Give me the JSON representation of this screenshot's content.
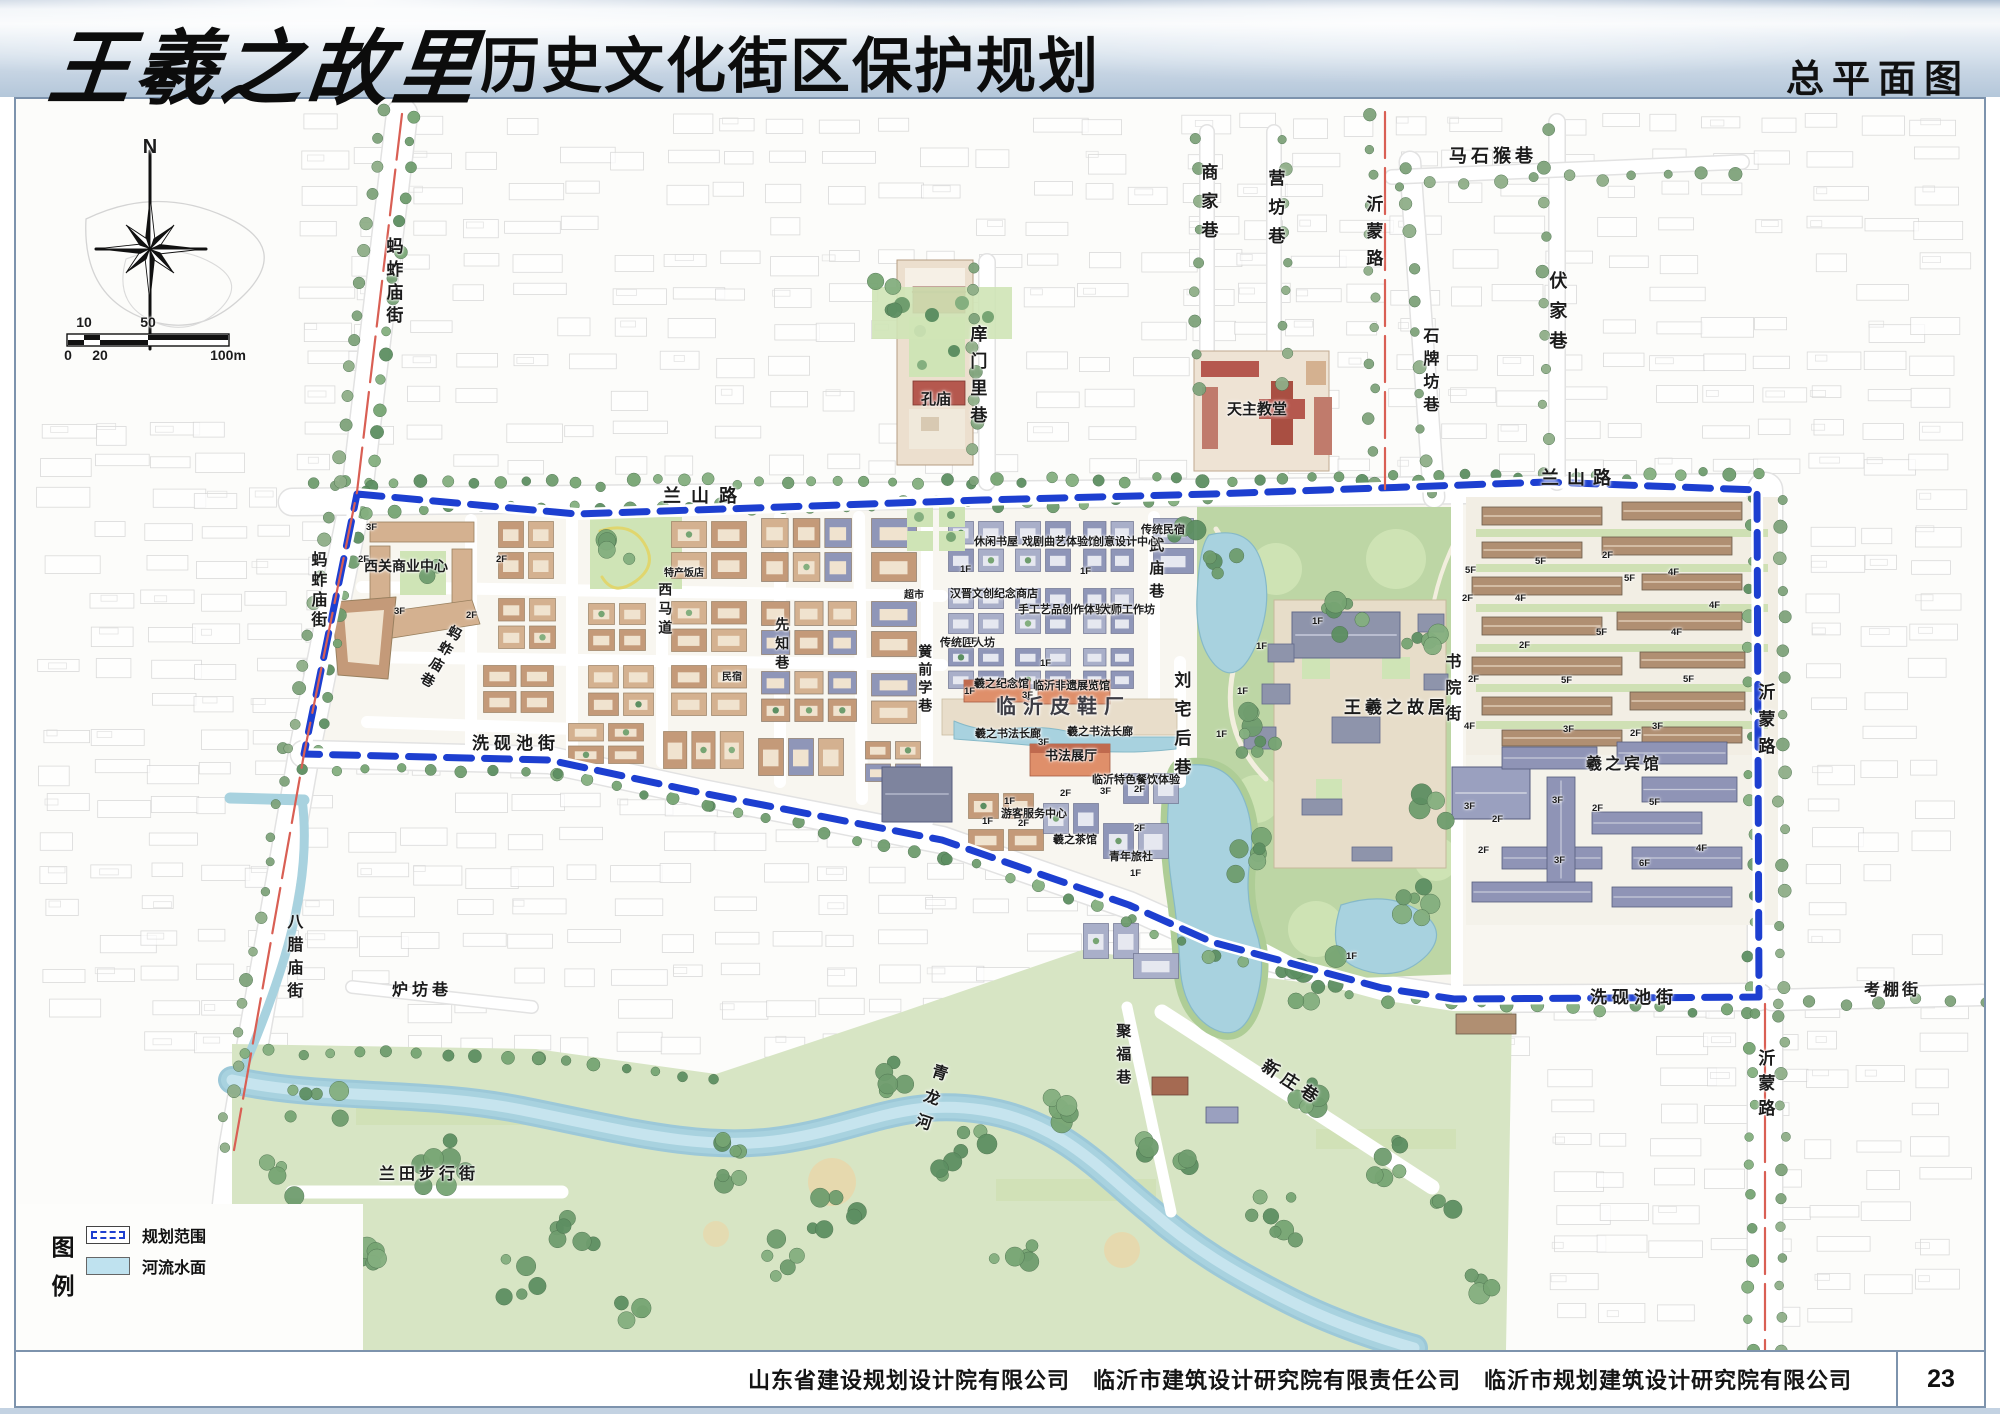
{
  "header": {
    "title_calligraphy": "王羲之故里",
    "title_rest": "历史文化街区保护规划",
    "corner_title": "总平面图"
  },
  "compass": {
    "label": "N"
  },
  "scalebar": {
    "top": [
      [
        "10",
        0.1
      ],
      [
        "50",
        0.5
      ]
    ],
    "bottom": [
      [
        "0",
        0
      ],
      [
        "20",
        0.2
      ],
      [
        "100m",
        1
      ]
    ]
  },
  "legend": {
    "title": "图例",
    "items": [
      {
        "label": "规划范围",
        "type": "boundary"
      },
      {
        "label": "河流水面",
        "type": "water"
      }
    ]
  },
  "footer": {
    "companies": "山东省建设规划设计院有限公司　临沂市建筑设计研究院有限责任公司　临沂市规划建筑设计研究院有限公司",
    "page": "23"
  },
  "colors": {
    "boundary": "#1d3fd0",
    "road_red": "#d95f54",
    "water": "#a8d2df",
    "water_edge": "#86b9c8",
    "park": "#bdd6a5",
    "lawn": "#cfe4b6",
    "band": "#d7e5c4",
    "tan_roof": "#c49a79",
    "tan_roof2": "#d4b190",
    "tan_body": "#f0e3cf",
    "blue_roof": "#8f96b8",
    "blue_roof2": "#a9afc9",
    "blue_body": "#e6e8f0",
    "red_roof": "#b5584e",
    "orange_roof": "#df8f6a",
    "plaza": "#e8ddca",
    "fabric": "#cfcfcf",
    "tree": [
      "#6f9d6e",
      "#84af7f",
      "#5d8f62",
      "#77a573"
    ],
    "tree_out": [
      "#7fa37b",
      "#8fae88"
    ]
  },
  "map_labels": [
    {
      "t": "N",
      "x": 134,
      "y": 38,
      "o": "h",
      "s": 20,
      "w": 800,
      "ctr": 1,
      "n": "north-label"
    },
    {
      "t": "蚂蚱庙街",
      "x": 368,
      "y": 138,
      "o": "v",
      "s": 17,
      "w": 700,
      "ls": 6,
      "n": "street-label"
    },
    {
      "t": "马石猴巷",
      "x": 1433,
      "y": 48,
      "o": "h",
      "s": 18,
      "w": 700,
      "ls": 4,
      "n": "street-label"
    },
    {
      "t": "商家巷",
      "x": 1183,
      "y": 64,
      "o": "v",
      "s": 17,
      "w": 700,
      "ls": 12,
      "n": "street-label"
    },
    {
      "t": "营坊巷",
      "x": 1250,
      "y": 70,
      "o": "v",
      "s": 17,
      "w": 700,
      "ls": 12,
      "n": "street-label"
    },
    {
      "t": "沂蒙路",
      "x": 1348,
      "y": 96,
      "o": "v",
      "s": 17,
      "w": 700,
      "ls": 10,
      "n": "street-label"
    },
    {
      "t": "伏家巷",
      "x": 1532,
      "y": 172,
      "o": "v",
      "s": 18,
      "w": 700,
      "ls": 12,
      "n": "street-label"
    },
    {
      "t": "石牌坊巷",
      "x": 1404,
      "y": 228,
      "o": "v",
      "s": 16,
      "w": 700,
      "ls": 7,
      "n": "street-label"
    },
    {
      "t": "庠门里巷",
      "x": 952,
      "y": 226,
      "o": "v",
      "s": 17,
      "w": 700,
      "ls": 10,
      "n": "street-label"
    },
    {
      "t": "孔庙",
      "x": 905,
      "y": 293,
      "o": "h",
      "s": 15,
      "w": 700,
      "n": "poi-label"
    },
    {
      "t": "天主教堂",
      "x": 1211,
      "y": 303,
      "o": "h",
      "s": 15,
      "w": 700,
      "n": "poi-label"
    },
    {
      "t": "兰山路",
      "x": 647,
      "y": 388,
      "o": "h",
      "s": 18,
      "w": 700,
      "ls": 10,
      "n": "street-label"
    },
    {
      "t": "兰山路",
      "x": 1525,
      "y": 370,
      "o": "h",
      "s": 18,
      "w": 700,
      "ls": 8,
      "n": "street-label"
    },
    {
      "t": "西关商业中心",
      "x": 348,
      "y": 460,
      "o": "h",
      "s": 14,
      "w": 700,
      "n": "poi-label"
    },
    {
      "t": "蚂蚱庙街",
      "x": 292,
      "y": 452,
      "o": "v",
      "s": 16,
      "w": 700,
      "ls": 4,
      "n": "street-label"
    },
    {
      "t": "蚂蚱庙巷",
      "x": 436,
      "y": 524,
      "o": "v",
      "s": 14,
      "w": 700,
      "r": 30,
      "ls": 4,
      "n": "street-label"
    },
    {
      "t": "洗砚池街",
      "x": 456,
      "y": 636,
      "o": "h",
      "s": 17,
      "w": 700,
      "ls": 5,
      "n": "street-label"
    },
    {
      "t": "西马道",
      "x": 642,
      "y": 483,
      "o": "v",
      "s": 14,
      "w": 700,
      "ls": 5,
      "n": "street-label"
    },
    {
      "t": "先知巷",
      "x": 759,
      "y": 518,
      "o": "v",
      "s": 14,
      "w": 700,
      "ls": 5,
      "n": "street-label"
    },
    {
      "t": "黉前学巷",
      "x": 902,
      "y": 545,
      "o": "v",
      "s": 14,
      "w": 700,
      "ls": 4,
      "n": "street-label"
    },
    {
      "t": "武庙巷",
      "x": 1132,
      "y": 438,
      "o": "v",
      "s": 15,
      "w": 700,
      "ls": 8,
      "n": "street-label"
    },
    {
      "t": "刘宅后巷",
      "x": 1156,
      "y": 572,
      "o": "v",
      "s": 17,
      "w": 700,
      "ls": 12,
      "n": "street-label"
    },
    {
      "t": "书院街",
      "x": 1426,
      "y": 554,
      "o": "v",
      "s": 16,
      "w": 700,
      "ls": 10,
      "n": "street-label"
    },
    {
      "t": "王羲之故居",
      "x": 1328,
      "y": 600,
      "o": "h",
      "s": 17,
      "w": 800,
      "ls": 4,
      "n": "poi-label"
    },
    {
      "t": "羲之宾馆",
      "x": 1570,
      "y": 658,
      "o": "h",
      "s": 16,
      "w": 800,
      "ls": 3,
      "n": "poi-label"
    },
    {
      "t": "沂蒙路",
      "x": 1740,
      "y": 584,
      "o": "v",
      "s": 17,
      "w": 700,
      "ls": 10,
      "n": "street-label"
    },
    {
      "t": "洗砚池街",
      "x": 1574,
      "y": 890,
      "o": "h",
      "s": 17,
      "w": 700,
      "ls": 5,
      "n": "street-label"
    },
    {
      "t": "考棚街",
      "x": 1848,
      "y": 884,
      "o": "h",
      "s": 16,
      "w": 700,
      "ls": 3,
      "n": "street-label"
    },
    {
      "t": "沂蒙路",
      "x": 1740,
      "y": 950,
      "o": "v",
      "s": 17,
      "w": 700,
      "ls": 8,
      "n": "street-label"
    },
    {
      "t": "八腊庙街",
      "x": 268,
      "y": 814,
      "o": "v",
      "s": 16,
      "w": 700,
      "ls": 7,
      "n": "street-label"
    },
    {
      "t": "炉坊巷",
      "x": 376,
      "y": 884,
      "o": "h",
      "s": 16,
      "w": 700,
      "ls": 4,
      "n": "street-label"
    },
    {
      "t": "兰田步行街",
      "x": 363,
      "y": 1068,
      "o": "h",
      "s": 16,
      "w": 700,
      "ls": 4,
      "n": "street-label"
    },
    {
      "t": "青龙河",
      "x": 916,
      "y": 962,
      "o": "v",
      "s": 16,
      "w": 700,
      "r": 18,
      "ls": 10,
      "n": "street-label"
    },
    {
      "t": "聚福巷",
      "x": 1099,
      "y": 924,
      "o": "v",
      "s": 15,
      "w": 700,
      "ls": 8,
      "n": "street-label"
    },
    {
      "t": "新庄巷",
      "x": 1252,
      "y": 958,
      "o": "h",
      "s": 17,
      "w": 700,
      "r": 33,
      "ls": 6,
      "n": "street-label"
    },
    {
      "t": "特产饭店",
      "x": 648,
      "y": 470,
      "o": "h",
      "s": 10,
      "w": 600,
      "n": "facility-label"
    },
    {
      "t": "民宿",
      "x": 706,
      "y": 574,
      "o": "h",
      "s": 10,
      "w": 600,
      "n": "facility-label"
    },
    {
      "t": "超市",
      "x": 888,
      "y": 492,
      "o": "h",
      "s": 10,
      "w": 600,
      "n": "facility-label"
    },
    {
      "t": "休闲书屋",
      "x": 958,
      "y": 438,
      "o": "h",
      "s": 11,
      "w": 600,
      "n": "facility-label"
    },
    {
      "t": "戏剧曲艺体验馆",
      "x": 1006,
      "y": 438,
      "o": "h",
      "s": 11,
      "w": 600,
      "n": "facility-label"
    },
    {
      "t": "创意设计中心",
      "x": 1077,
      "y": 438,
      "o": "h",
      "s": 11,
      "w": 600,
      "n": "facility-label"
    },
    {
      "t": "传统民宿",
      "x": 1125,
      "y": 426,
      "o": "h",
      "s": 11,
      "w": 600,
      "n": "facility-label"
    },
    {
      "t": "汉晋文创纪念商店",
      "x": 934,
      "y": 490,
      "o": "h",
      "s": 11,
      "w": 600,
      "n": "facility-label"
    },
    {
      "t": "手工艺品创作体验馆",
      "x": 1002,
      "y": 506,
      "o": "h",
      "s": 11,
      "w": 600,
      "n": "facility-label"
    },
    {
      "t": "大师工作坊",
      "x": 1084,
      "y": 506,
      "o": "h",
      "s": 11,
      "w": 600,
      "n": "facility-label"
    },
    {
      "t": "传统匠人坊",
      "x": 924,
      "y": 539,
      "o": "h",
      "s": 11,
      "w": 600,
      "n": "facility-label"
    },
    {
      "t": "羲之纪念馆",
      "x": 958,
      "y": 580,
      "o": "h",
      "s": 11,
      "w": 700,
      "n": "facility-label"
    },
    {
      "t": "临沂非遗展览馆",
      "x": 1017,
      "y": 582,
      "o": "h",
      "s": 11,
      "w": 700,
      "n": "facility-label"
    },
    {
      "t": "临沂皮鞋厂",
      "x": 980,
      "y": 598,
      "o": "h",
      "s": 20,
      "w": 800,
      "ls": 7,
      "c": "#3c3c44",
      "n": "poi-label"
    },
    {
      "t": "羲之书法长廊",
      "x": 959,
      "y": 630,
      "o": "h",
      "s": 11,
      "w": 700,
      "n": "facility-label"
    },
    {
      "t": "羲之书法长廊",
      "x": 1051,
      "y": 628,
      "o": "h",
      "s": 11,
      "w": 700,
      "n": "facility-label"
    },
    {
      "t": "书法展厅",
      "x": 1029,
      "y": 650,
      "o": "h",
      "s": 13,
      "w": 700,
      "n": "facility-label"
    },
    {
      "t": "临沂特色餐饮体验",
      "x": 1076,
      "y": 676,
      "o": "h",
      "s": 11,
      "w": 600,
      "n": "facility-label"
    },
    {
      "t": "游客服务中心",
      "x": 985,
      "y": 710,
      "o": "h",
      "s": 11,
      "w": 600,
      "n": "facility-label"
    },
    {
      "t": "羲之茶馆",
      "x": 1037,
      "y": 736,
      "o": "h",
      "s": 11,
      "w": 600,
      "n": "facility-label"
    },
    {
      "t": "青年旅社",
      "x": 1093,
      "y": 753,
      "o": "h",
      "s": 11,
      "w": 600,
      "n": "facility-label"
    }
  ],
  "floor_labels": [
    [
      "3F",
      350,
      424
    ],
    [
      "2F",
      342,
      456
    ],
    [
      "2F",
      480,
      456
    ],
    [
      "3F",
      378,
      508
    ],
    [
      "2F",
      450,
      512
    ],
    [
      "1F",
      944,
      466
    ],
    [
      "1F",
      1064,
      468
    ],
    [
      "1F",
      950,
      538
    ],
    [
      "1F",
      1024,
      560
    ],
    [
      "1F",
      948,
      588
    ],
    [
      "3F",
      1006,
      592
    ],
    [
      "3F",
      1022,
      639
    ],
    [
      "1F",
      988,
      698
    ],
    [
      "2F",
      1044,
      690
    ],
    [
      "2F",
      1118,
      686
    ],
    [
      "3F",
      1084,
      688
    ],
    [
      "1F",
      966,
      718
    ],
    [
      "2F",
      1002,
      720
    ],
    [
      "2F",
      1118,
      725
    ],
    [
      "1F",
      1114,
      770
    ],
    [
      "1F",
      1296,
      518
    ],
    [
      "1F",
      1240,
      543
    ],
    [
      "1F",
      1221,
      588
    ],
    [
      "1F",
      1200,
      631
    ],
    [
      "1F",
      1330,
      853
    ],
    [
      "5F",
      1449,
      467
    ],
    [
      "2F",
      1446,
      495
    ],
    [
      "2F",
      1452,
      576
    ],
    [
      "4F",
      1448,
      623
    ],
    [
      "3F",
      1448,
      703
    ],
    [
      "5F",
      1519,
      458
    ],
    [
      "2F",
      1586,
      452
    ],
    [
      "5F",
      1608,
      475
    ],
    [
      "4F",
      1652,
      469
    ],
    [
      "4F",
      1499,
      495
    ],
    [
      "4F",
      1693,
      502
    ],
    [
      "5F",
      1580,
      529
    ],
    [
      "4F",
      1655,
      529
    ],
    [
      "2F",
      1503,
      542
    ],
    [
      "5F",
      1545,
      577
    ],
    [
      "5F",
      1667,
      576
    ],
    [
      "3F",
      1547,
      626
    ],
    [
      "2F",
      1614,
      630
    ],
    [
      "3F",
      1636,
      623
    ],
    [
      "3F",
      1536,
      697
    ],
    [
      "2F",
      1576,
      705
    ],
    [
      "5F",
      1633,
      699
    ],
    [
      "3F",
      1538,
      757
    ],
    [
      "2F",
      1476,
      716
    ],
    [
      "6F",
      1623,
      760
    ],
    [
      "2F",
      1462,
      747
    ],
    [
      "4F",
      1680,
      745
    ]
  ]
}
